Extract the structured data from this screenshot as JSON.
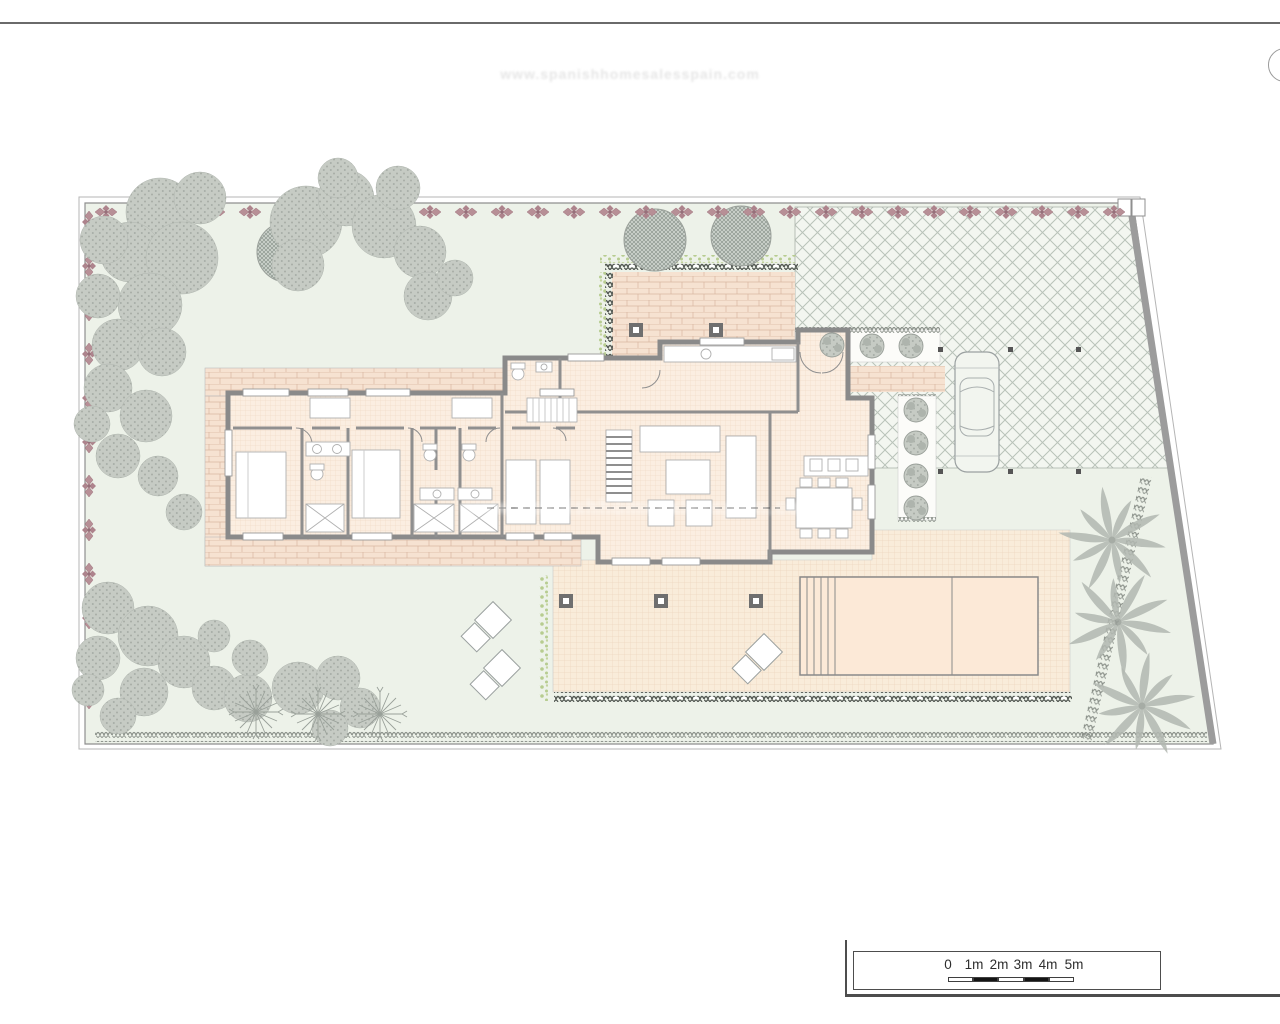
{
  "watermark": {
    "text": "www.spanishhomesalesspain.com"
  },
  "scale_bar": {
    "labels": [
      "0",
      "1m",
      "2m",
      "3m",
      "4m",
      "5m"
    ],
    "text_color": "#2d2d2d"
  },
  "colors": {
    "lawn": "#edf2e9",
    "terrace_brick": "#f6e2d1",
    "interior_floor": "#fbeee1",
    "pool_deck": "#f9ecda",
    "pool_water": "#fce9d7",
    "walls": "#8a8a8a",
    "flower_border": "#b78f96",
    "gray_foliage": "#c6cbc4",
    "paving_hatch_line": "#b9c3b9",
    "frame_line": "#4d4d4d"
  }
}
